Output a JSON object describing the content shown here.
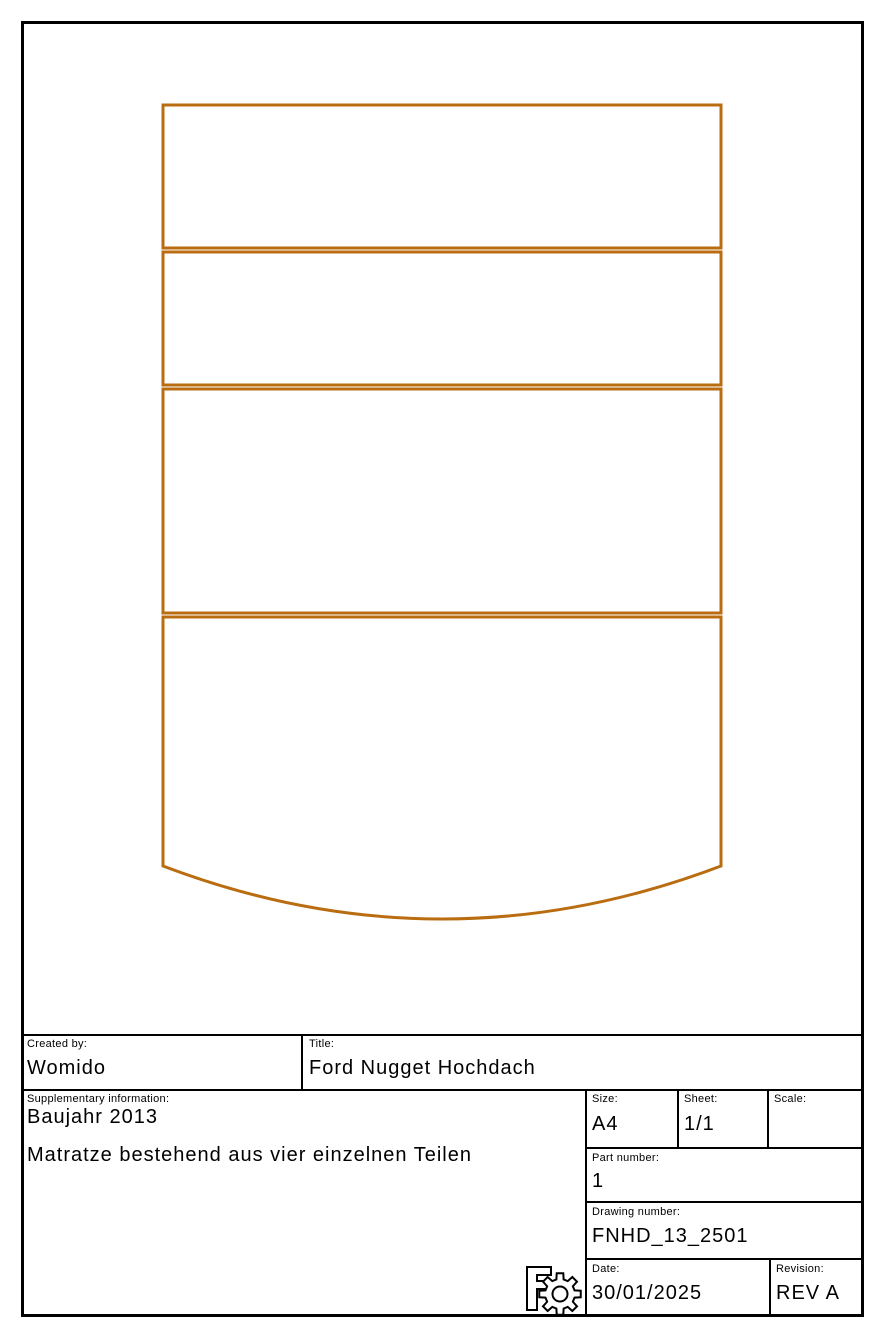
{
  "page": {
    "background": "#ffffff",
    "frame_color": "#000000"
  },
  "drawing": {
    "type": "technical-drawing",
    "panel_count": 4,
    "outline_color": "#B96D10"
  },
  "title_block": {
    "created_by": {
      "label": "Created by:",
      "value": "Womido"
    },
    "title": {
      "label": "Title:",
      "value": "Ford Nugget Hochdach"
    },
    "supplementary": {
      "label": "Supplementary information:",
      "line1": "Baujahr 2013",
      "line2": "Matratze bestehend aus vier einzelnen Teilen"
    },
    "size": {
      "label": "Size:",
      "value": "A4"
    },
    "sheet": {
      "label": "Sheet:",
      "value": "1/1"
    },
    "scale": {
      "label": "Scale:",
      "value": ""
    },
    "part_number": {
      "label": "Part number:",
      "value": "1"
    },
    "drawing_number": {
      "label": "Drawing number:",
      "value": "FNHD_13_2501"
    },
    "date": {
      "label": "Date:",
      "value": "30/01/2025"
    },
    "revision": {
      "label": "Revision:",
      "value": "REV A"
    },
    "logo_icon": "freecad-gear-icon"
  }
}
